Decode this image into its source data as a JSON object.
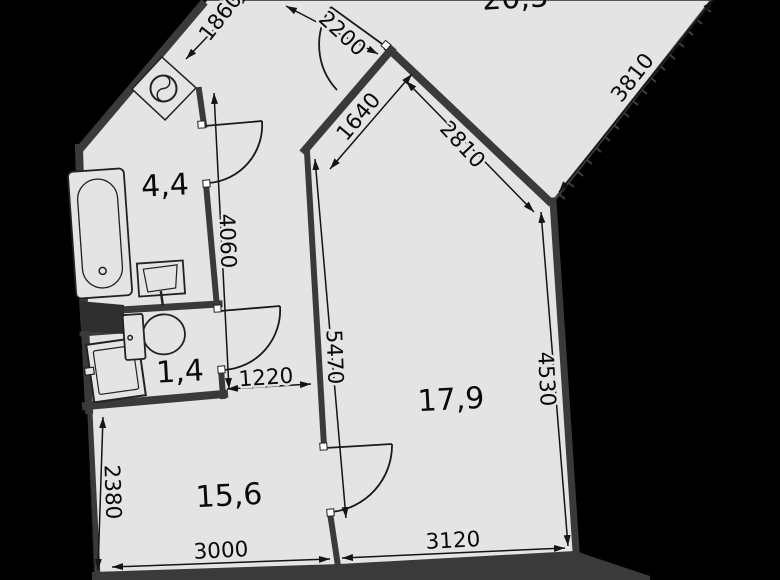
{
  "plan": {
    "rooms": {
      "bathroom": {
        "area": "4,4"
      },
      "toilet": {
        "area": "1,4"
      },
      "room_15_6": {
        "area": "15,6"
      },
      "room_17_9": {
        "area": "17,9"
      },
      "room_top": {
        "area": "20,5"
      }
    },
    "dimensions": {
      "d1860": "1860",
      "d2200": "2200",
      "d3810": "3810",
      "d1640": "1640",
      "d2810": "2810",
      "d4060": "4060",
      "d5470": "5470",
      "d4530": "4530",
      "d1220": "1220",
      "d2380": "2380",
      "d3000": "3000",
      "d3120": "3120"
    },
    "fixtures": {
      "bathtub": "bathtub",
      "washbasin_bath": "washbasin",
      "washbasin_wc": "washbasin",
      "wc": "toilet",
      "vent": "ventilation-shaft"
    },
    "colors": {
      "background": "#000000",
      "floor": "#e4e4e4",
      "wall": "#3a3a3a",
      "line": "#141414"
    }
  }
}
